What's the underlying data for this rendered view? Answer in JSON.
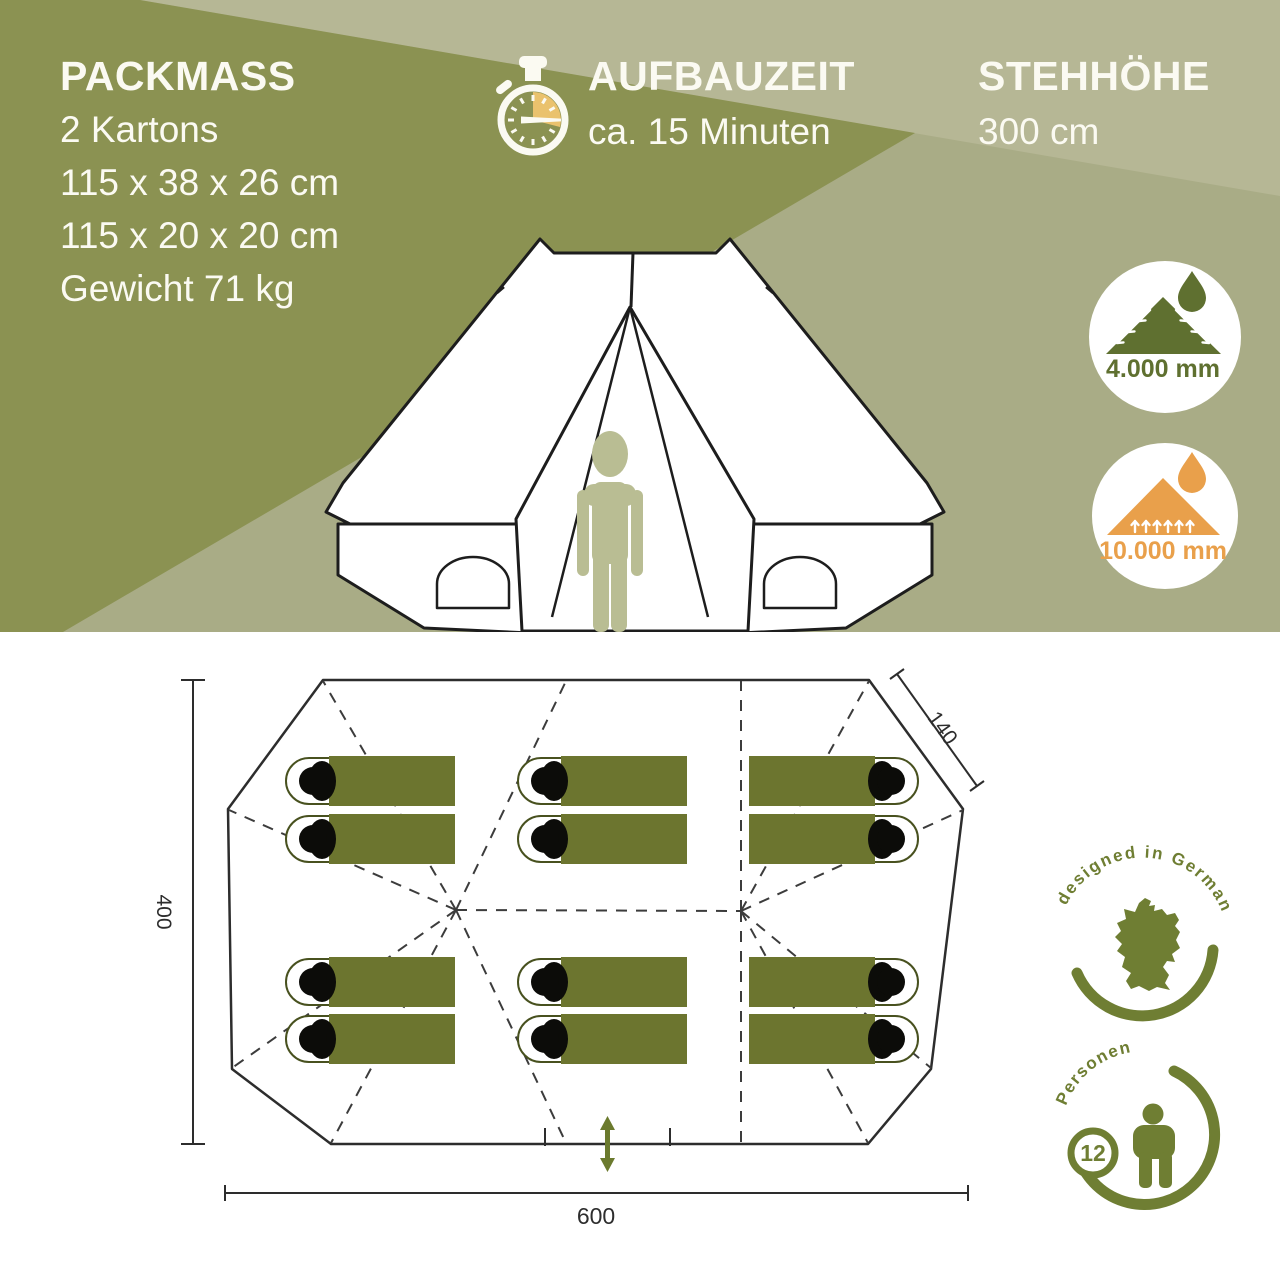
{
  "colors": {
    "banner_bg": "#a9ac86",
    "banner_band_light": "#b6b795",
    "banner_wedge_dark": "#8b9252",
    "text_light": "#fbfaf2",
    "accent_olive": "#6f7e33",
    "mountain_olive": "#5f7030",
    "accent_orange": "#e9a04b",
    "stopwatch_yellow": "#eac26d",
    "sleeping_bag_green": "#6c752f",
    "person_sage": "#b9bd93",
    "plan_line": "#2d2d2d"
  },
  "banner": {
    "packmass": {
      "title": "PACKMASS",
      "lines": [
        "2 Kartons",
        "115 x 38 x 26 cm",
        "115 x 20 x 20 cm",
        "Gewicht 71 kg"
      ]
    },
    "aufbauzeit": {
      "title": "AUFBAUZEIT",
      "value": "ca. 15 Minuten"
    },
    "stehhoehe": {
      "title": "STEHHÖHE",
      "value": "300 cm"
    },
    "watercolumn_roof": "4.000 mm",
    "watercolumn_floor": "10.000 mm"
  },
  "floorplan": {
    "dim_length": "600",
    "dim_width": "400",
    "dim_side": "140",
    "designed_badge": "designed in Germany",
    "persons_badge": {
      "count": "12",
      "label": "Personen"
    }
  }
}
